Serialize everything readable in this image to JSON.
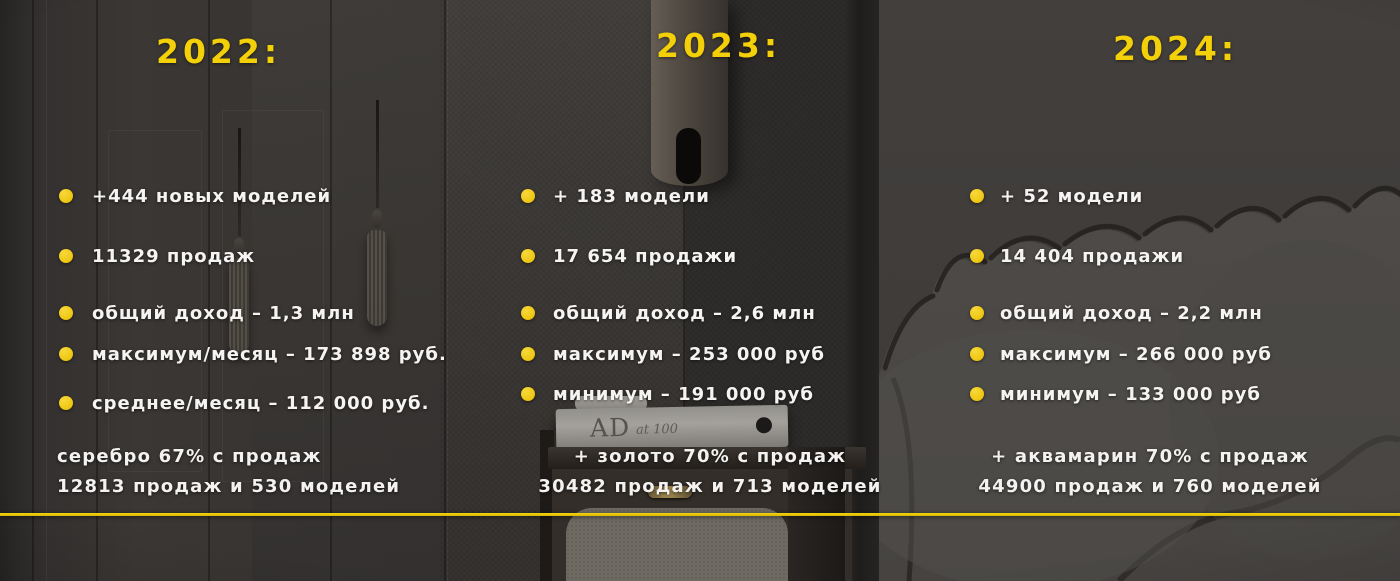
{
  "slide": {
    "accent_yellow": "#F2CC0C",
    "bullet_yellow": "#EFC713",
    "text_color": "#F5F4F2",
    "background_tone": "#35322F"
  },
  "background": {
    "book_text_primary": "AD",
    "book_text_secondary": "at 100"
  },
  "columns": [
    {
      "year_label": "2022:",
      "bullets": [
        "+444 новых моделей",
        "11329 продаж",
        "общий доход – 1,3 млн",
        "максимум/месяц – 173 898 руб.",
        "среднее/месяц – 112 000 руб."
      ],
      "summary": [
        "серебро 67% с продаж",
        "12813 продаж и 530 моделей"
      ]
    },
    {
      "year_label": "2023:",
      "bullets": [
        "+ 183 модели",
        "17 654 продажи",
        "общий доход – 2,6 млн",
        "максимум – 253 000 руб",
        "минимум – 191 000 руб"
      ],
      "summary": [
        "+ золото 70% с продаж",
        "30482 продаж и 713 моделей"
      ]
    },
    {
      "year_label": "2024:",
      "bullets": [
        "+ 52 модели",
        "14 404 продажи",
        "общий доход – 2,2 млн",
        "максимум – 266 000 руб",
        "минимум – 133 000 руб"
      ],
      "summary": [
        "+ аквамарин 70% с продаж",
        "44900 продаж и 760 моделей"
      ]
    }
  ]
}
